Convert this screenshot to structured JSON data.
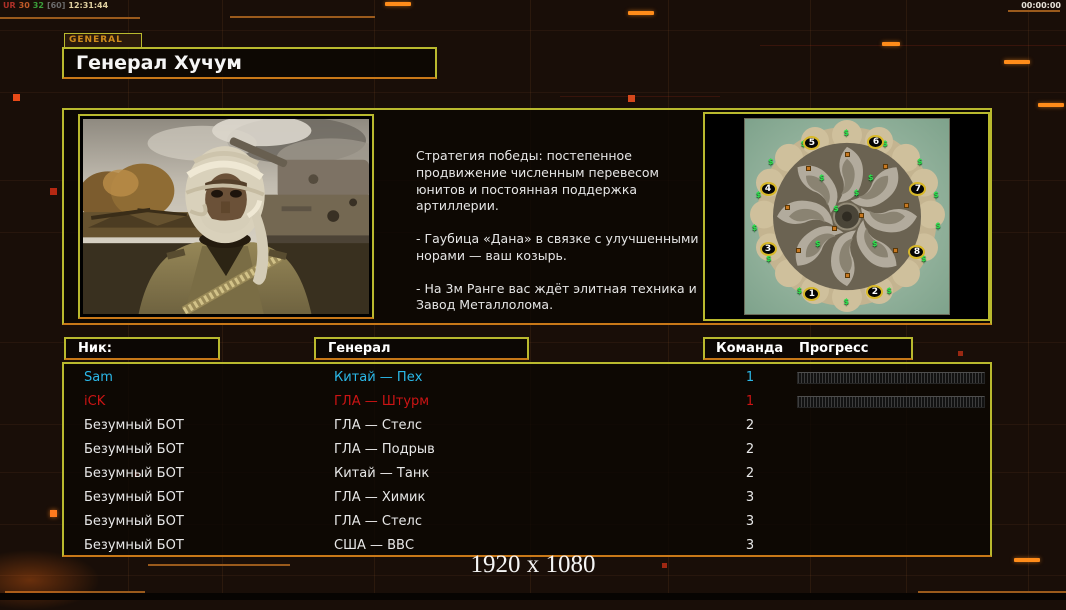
{
  "overlay": {
    "tokens": [
      {
        "text": "UR",
        "color": "#b03028"
      },
      {
        "text": "30",
        "color": "#c05a28"
      },
      {
        "text": "32",
        "color": "#3aa03a"
      },
      {
        "text": "[60]",
        "color": "#6a6a6a"
      },
      {
        "text": "12:31:44",
        "color": "#e0d0a0"
      }
    ],
    "clock": "00:00:00"
  },
  "general_panel": {
    "tab_label": "GENERAL",
    "title": "Генерал Хучум"
  },
  "briefing": {
    "paragraphs": [
      "Стратегия победы: постепенное продвижение численным перевесом юнитов и постоянная поддержка артиллерии.",
      "- Гаубица «Дана» в связке с улучшенными норами — ваш козырь.",
      "- На 3м Ранге вас ждёт элитная техника и Завод Металлолома."
    ]
  },
  "map": {
    "start_positions": [
      {
        "n": "5",
        "x": 32.8,
        "y": 12.2
      },
      {
        "n": "6",
        "x": 64.2,
        "y": 11.8
      },
      {
        "n": "4",
        "x": 11.3,
        "y": 35.7
      },
      {
        "n": "7",
        "x": 84.8,
        "y": 35.9
      },
      {
        "n": "3",
        "x": 11.3,
        "y": 66.8
      },
      {
        "n": "8",
        "x": 84.3,
        "y": 68.4
      },
      {
        "n": "1",
        "x": 32.8,
        "y": 89.8
      },
      {
        "n": "2",
        "x": 63.7,
        "y": 88.8
      }
    ],
    "supply_markers": [
      {
        "x": 50,
        "y": 7
      },
      {
        "x": 29,
        "y": 13
      },
      {
        "x": 69,
        "y": 13
      },
      {
        "x": 13,
        "y": 22
      },
      {
        "x": 86,
        "y": 22
      },
      {
        "x": 7,
        "y": 39
      },
      {
        "x": 94,
        "y": 39
      },
      {
        "x": 5,
        "y": 56
      },
      {
        "x": 95,
        "y": 55
      },
      {
        "x": 12,
        "y": 72
      },
      {
        "x": 88,
        "y": 72
      },
      {
        "x": 27,
        "y": 88
      },
      {
        "x": 71,
        "y": 88
      },
      {
        "x": 50,
        "y": 94
      },
      {
        "x": 38,
        "y": 30
      },
      {
        "x": 62,
        "y": 30
      },
      {
        "x": 36,
        "y": 64
      },
      {
        "x": 64,
        "y": 64
      },
      {
        "x": 45,
        "y": 46
      },
      {
        "x": 55,
        "y": 38
      }
    ],
    "building_markers": [
      {
        "x": 50,
        "y": 18
      },
      {
        "x": 31,
        "y": 25
      },
      {
        "x": 69,
        "y": 24
      },
      {
        "x": 21,
        "y": 45
      },
      {
        "x": 79,
        "y": 44
      },
      {
        "x": 26,
        "y": 67
      },
      {
        "x": 74,
        "y": 67
      },
      {
        "x": 44,
        "y": 56
      },
      {
        "x": 50,
        "y": 80
      },
      {
        "x": 57,
        "y": 49
      }
    ]
  },
  "roster": {
    "headers": {
      "nick": "Ник:",
      "general": "Генерал",
      "team": "Команда",
      "progress": "Прогресс"
    },
    "rows": [
      {
        "nick": "Sam",
        "general": "Китай — Пех",
        "team": "1",
        "color": "#2bb8e8",
        "progress": true
      },
      {
        "nick": "iCK",
        "general": "ГЛА — Штурм",
        "team": "1",
        "color": "#cc1414",
        "progress": true
      },
      {
        "nick": "Безумный БОТ",
        "general": "ГЛА — Стелс",
        "team": "2",
        "color": "#e8e8e8",
        "progress": false
      },
      {
        "nick": "Безумный БОТ",
        "general": "ГЛА — Подрыв",
        "team": "2",
        "color": "#e8e8e8",
        "progress": false
      },
      {
        "nick": "Безумный БОТ",
        "general": "Китай — Танк",
        "team": "2",
        "color": "#e8e8e8",
        "progress": false
      },
      {
        "nick": "Безумный БОТ",
        "general": "ГЛА — Химик",
        "team": "3",
        "color": "#e8e8e8",
        "progress": false
      },
      {
        "nick": "Безумный БОТ",
        "general": "ГЛА — Стелс",
        "team": "3",
        "color": "#e8e8e8",
        "progress": false
      },
      {
        "nick": "Безумный БОТ",
        "general": "США — ВВС",
        "team": "3",
        "color": "#e8e8e8",
        "progress": false
      }
    ]
  },
  "footer": {
    "resolution": "1920 x 1080"
  },
  "colors": {
    "panel_border": "#b9b92e",
    "accent_orange": "#c87818",
    "bright_orange": "#ff8c1a",
    "player_cyan": "#2bb8e8",
    "player_red": "#cc1414"
  }
}
